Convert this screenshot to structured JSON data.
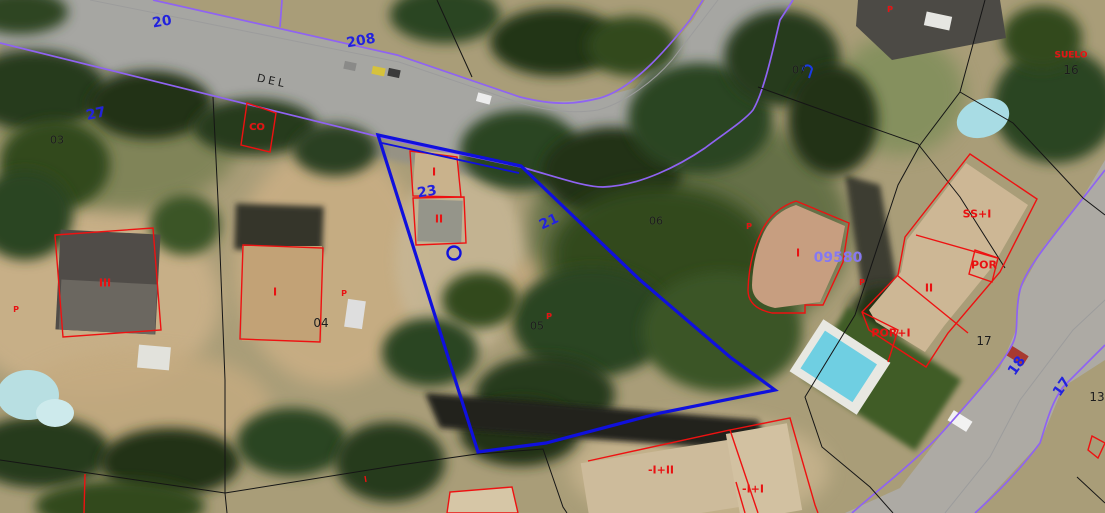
{
  "map": {
    "kind": "cadastral-parcel-map-over-aerial-imagery",
    "street_label": "DEL",
    "selected_parcel_ref": "09580",
    "colors": {
      "parcel_selection_blue": "#1010dd",
      "road_edge_purple": "#8f63f2",
      "building_outline_red": "#ee1111",
      "parcel_number_blue": "#2222dd",
      "reference_violet": "#8678f0",
      "label_black": "#1c1c1c",
      "boundary_black": "#151515",
      "road_centerline_gray": "#9c9c9c"
    },
    "labels": [
      {
        "name": "street-number-20",
        "text": "20",
        "color": "blue",
        "x": 162,
        "y": 22,
        "rot": -10,
        "size": 14
      },
      {
        "name": "street-number-208",
        "text": "208",
        "color": "blue",
        "x": 361,
        "y": 41,
        "rot": -10,
        "size": 14
      },
      {
        "name": "parcel-27",
        "text": "27",
        "color": "blue",
        "x": 96,
        "y": 114,
        "rot": -12,
        "size": 14
      },
      {
        "name": "parcel-03",
        "text": "03",
        "color": "black",
        "x": 57,
        "y": 140,
        "rot": 0,
        "size": 11
      },
      {
        "name": "street-name-del",
        "text": "DEL",
        "color": "black",
        "x": 272,
        "y": 81,
        "rot": 12,
        "size": 11,
        "spacing": 3
      },
      {
        "name": "building-co",
        "text": "CO",
        "color": "red",
        "x": 257,
        "y": 128,
        "rot": 0,
        "size": 10
      },
      {
        "name": "parcel-23",
        "text": "23",
        "color": "blue",
        "x": 427,
        "y": 192,
        "rot": -10,
        "size": 14
      },
      {
        "name": "building-height-i-05",
        "text": "I",
        "color": "red",
        "x": 434,
        "y": 172,
        "rot": 0,
        "size": 11
      },
      {
        "name": "building-height-ii-05",
        "text": "II",
        "color": "red",
        "x": 439,
        "y": 219,
        "rot": 0,
        "size": 11
      },
      {
        "name": "parcel-21",
        "text": "21",
        "color": "blue",
        "x": 549,
        "y": 222,
        "rot": -25,
        "size": 14
      },
      {
        "name": "parcel-05",
        "text": "05",
        "color": "black",
        "x": 537,
        "y": 326,
        "rot": 0,
        "size": 11
      },
      {
        "name": "porch-p-05",
        "text": "P",
        "color": "red",
        "x": 549,
        "y": 317,
        "rot": 0,
        "size": 8
      },
      {
        "name": "parcel-06",
        "text": "06",
        "color": "black",
        "x": 656,
        "y": 221,
        "rot": 0,
        "size": 11
      },
      {
        "name": "parcel-07",
        "text": "07",
        "color": "black",
        "x": 799,
        "y": 70,
        "rot": 0,
        "size": 11
      },
      {
        "name": "porch-p-top",
        "text": "P",
        "color": "red",
        "x": 890,
        "y": 10,
        "rot": 0,
        "size": 8
      },
      {
        "name": "suelo-label",
        "text": "SUELO",
        "color": "red",
        "x": 1071,
        "y": 56,
        "rot": 0,
        "size": 9
      },
      {
        "name": "parcel-16",
        "text": "16",
        "color": "black",
        "x": 1071,
        "y": 70,
        "rot": 0,
        "size": 12
      },
      {
        "name": "building-height-iii",
        "text": "III",
        "color": "red",
        "x": 105,
        "y": 283,
        "rot": 0,
        "size": 11
      },
      {
        "name": "porch-p-left",
        "text": "P",
        "color": "red",
        "x": 16,
        "y": 310,
        "rot": 0,
        "size": 8
      },
      {
        "name": "building-height-i-04",
        "text": "I",
        "color": "red",
        "x": 275,
        "y": 292,
        "rot": 0,
        "size": 11
      },
      {
        "name": "parcel-04",
        "text": "04",
        "color": "black",
        "x": 321,
        "y": 323,
        "rot": 0,
        "size": 12
      },
      {
        "name": "porch-p-04",
        "text": "P",
        "color": "red",
        "x": 344,
        "y": 294,
        "rot": 0,
        "size": 8
      },
      {
        "name": "porch-p-round",
        "text": "P",
        "color": "red",
        "x": 749,
        "y": 227,
        "rot": 0,
        "size": 8
      },
      {
        "name": "building-height-i-round",
        "text": "I",
        "color": "red",
        "x": 798,
        "y": 253,
        "rot": 0,
        "size": 11
      },
      {
        "name": "ref-09580",
        "text": "09580",
        "color": "violet",
        "x": 838,
        "y": 258,
        "rot": 0,
        "size": 14
      },
      {
        "name": "building-ss-i",
        "text": "SS+I",
        "color": "red",
        "x": 977,
        "y": 214,
        "rot": 0,
        "size": 11
      },
      {
        "name": "building-por",
        "text": "POR",
        "color": "red",
        "x": 984,
        "y": 265,
        "rot": 0,
        "size": 11
      },
      {
        "name": "building-height-ii-17",
        "text": "II",
        "color": "red",
        "x": 929,
        "y": 288,
        "rot": 0,
        "size": 11
      },
      {
        "name": "porch-p-17",
        "text": "P",
        "color": "red",
        "x": 862,
        "y": 283,
        "rot": 0,
        "size": 8
      },
      {
        "name": "building-por-i",
        "text": "POR+I",
        "color": "red",
        "x": 891,
        "y": 333,
        "rot": 0,
        "size": 11
      },
      {
        "name": "parcel-17",
        "text": "17",
        "color": "black",
        "x": 984,
        "y": 341,
        "rot": 0,
        "size": 12
      },
      {
        "name": "building-neg-i-plus-ii",
        "text": "-I+II",
        "color": "red",
        "x": 661,
        "y": 470,
        "rot": 0,
        "size": 11
      },
      {
        "name": "building-neg-i-plus-i",
        "text": "-I+I",
        "color": "red",
        "x": 753,
        "y": 489,
        "rot": 0,
        "size": 11
      },
      {
        "name": "street-number-18",
        "text": "18",
        "color": "blue",
        "x": 1017,
        "y": 366,
        "rot": -55,
        "size": 14
      },
      {
        "name": "street-number-17",
        "text": "17",
        "color": "blue",
        "x": 1062,
        "y": 387,
        "rot": -55,
        "size": 14
      },
      {
        "name": "parcel-13",
        "text": "13",
        "color": "black",
        "x": 1097,
        "y": 397,
        "rot": 0,
        "size": 12
      }
    ]
  }
}
